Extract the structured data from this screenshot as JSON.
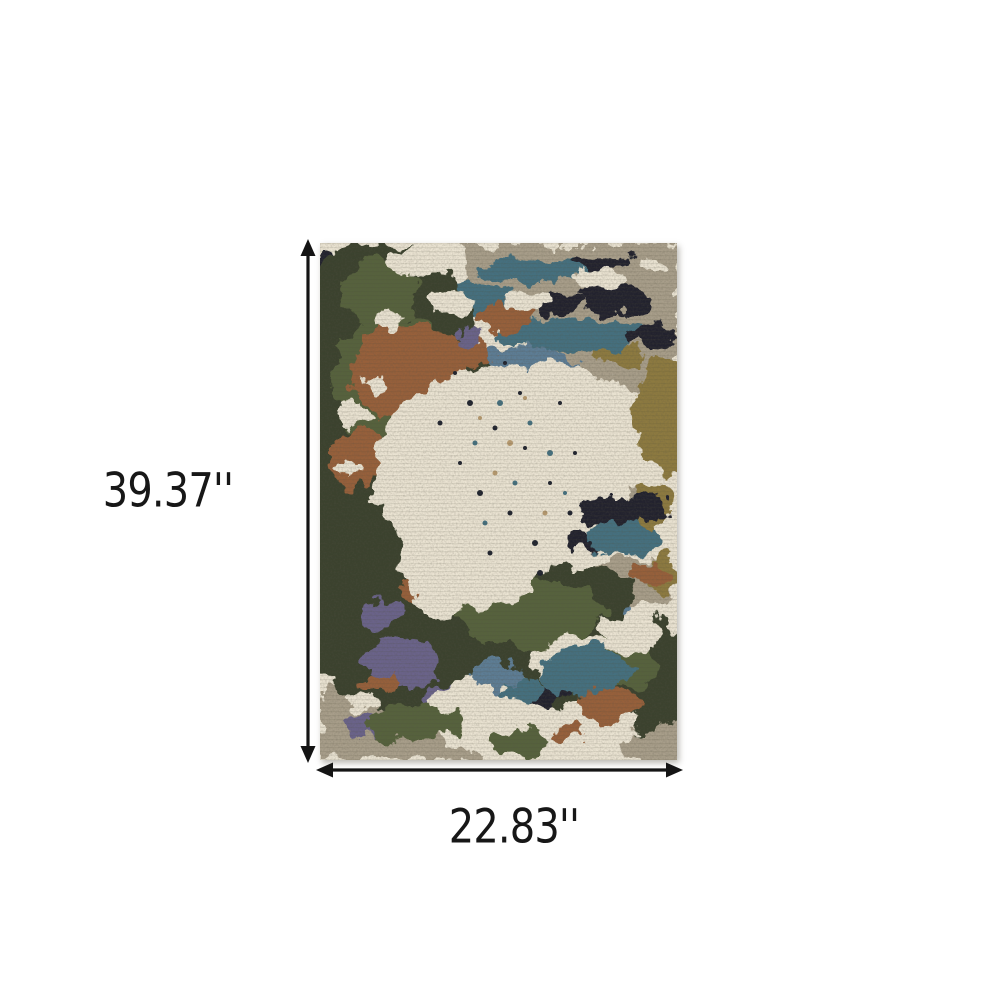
{
  "product_diagram": {
    "height_label": "39.37''",
    "width_label": "22.83''",
    "arrow_color": "#141414",
    "label_color": "#171717"
  },
  "rug": {
    "alt": "abstract-distressed-area-rug",
    "palette": {
      "ivory": "#eae3d2",
      "taupe": "#a89e8a",
      "dark_olive": "#3b432e",
      "olive": "#57623c",
      "teal": "#45707f",
      "steel_blue": "#5d7d95",
      "navy": "#20242f",
      "rust": "#97603a",
      "gold": "#8d7a3f",
      "mauve": "#6b648a",
      "tan": "#b79a6f"
    }
  }
}
